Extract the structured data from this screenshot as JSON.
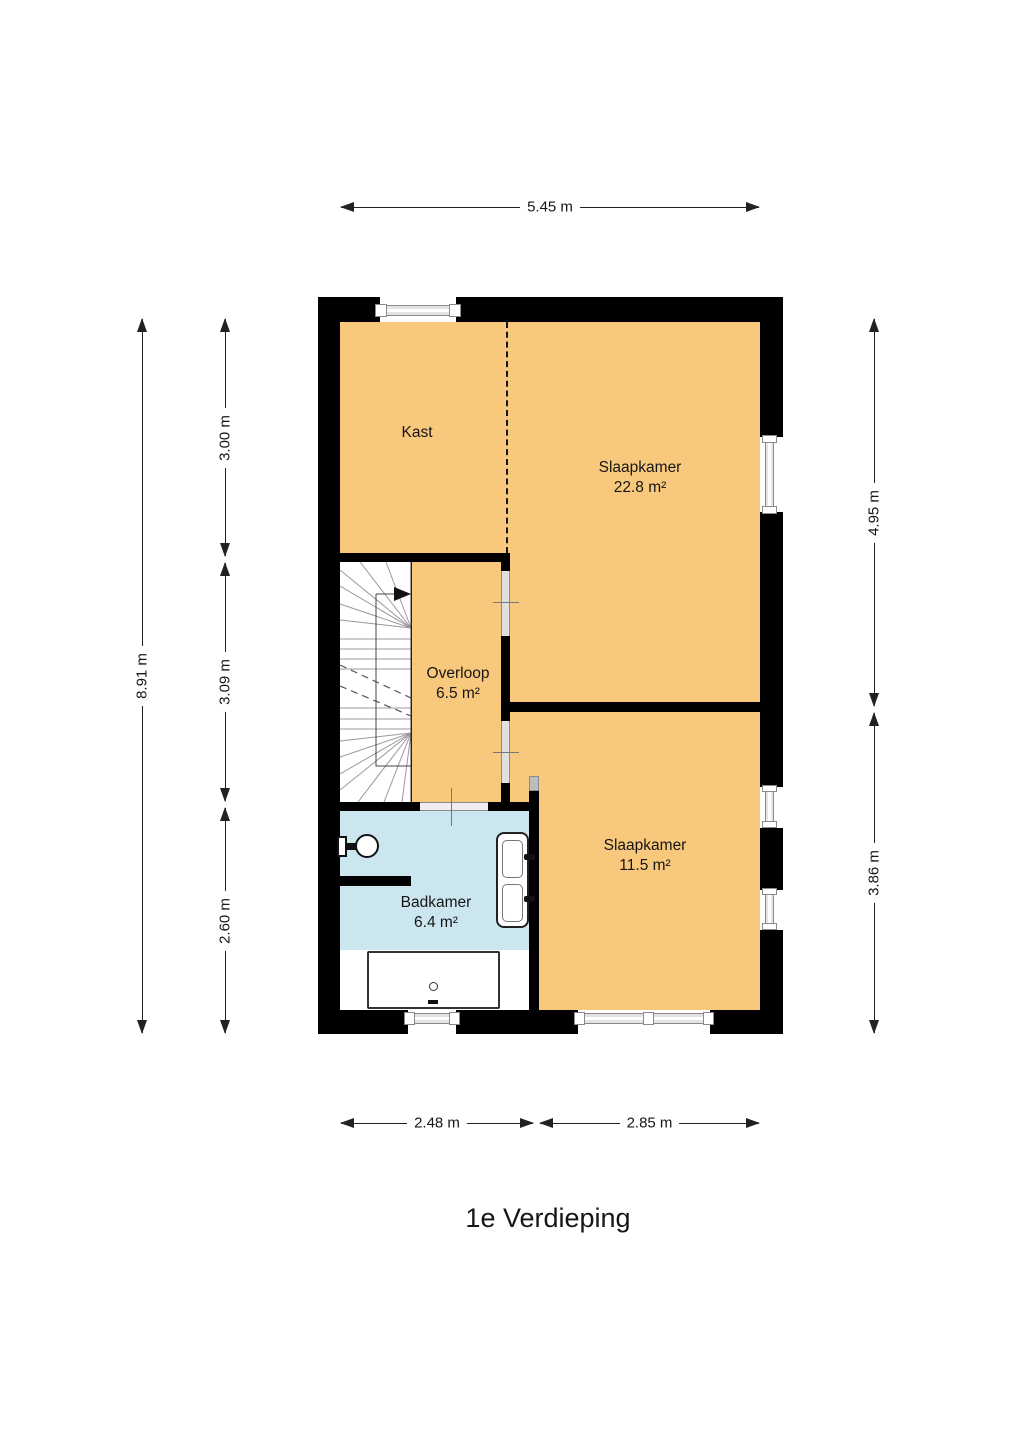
{
  "page": {
    "title": "1e Verdieping"
  },
  "rooms": {
    "kast": {
      "name": "Kast"
    },
    "slaapkamer_groot": {
      "name": "Slaapkamer",
      "area": "22.8 m²"
    },
    "overloop": {
      "name": "Overloop",
      "area": "6.5 m²"
    },
    "slaapkamer_klein": {
      "name": "Slaapkamer",
      "area": "11.5 m²"
    },
    "badkamer": {
      "name": "Badkamer",
      "area": "6.4 m²"
    }
  },
  "dimensions": {
    "top_width": "5.45 m",
    "left_total": "8.91 m",
    "left_top": "3.00 m",
    "left_middle": "3.09 m",
    "left_bottom": "2.60 m",
    "right_top": "4.95 m",
    "right_bottom": "3.86 m",
    "bottom_left": "2.48 m",
    "bottom_right": "2.85 m"
  },
  "colors": {
    "floor": "#F8C87C",
    "bathroom_floor": "#CBE6EE",
    "wall": "#000000",
    "dimension": "#222222"
  }
}
